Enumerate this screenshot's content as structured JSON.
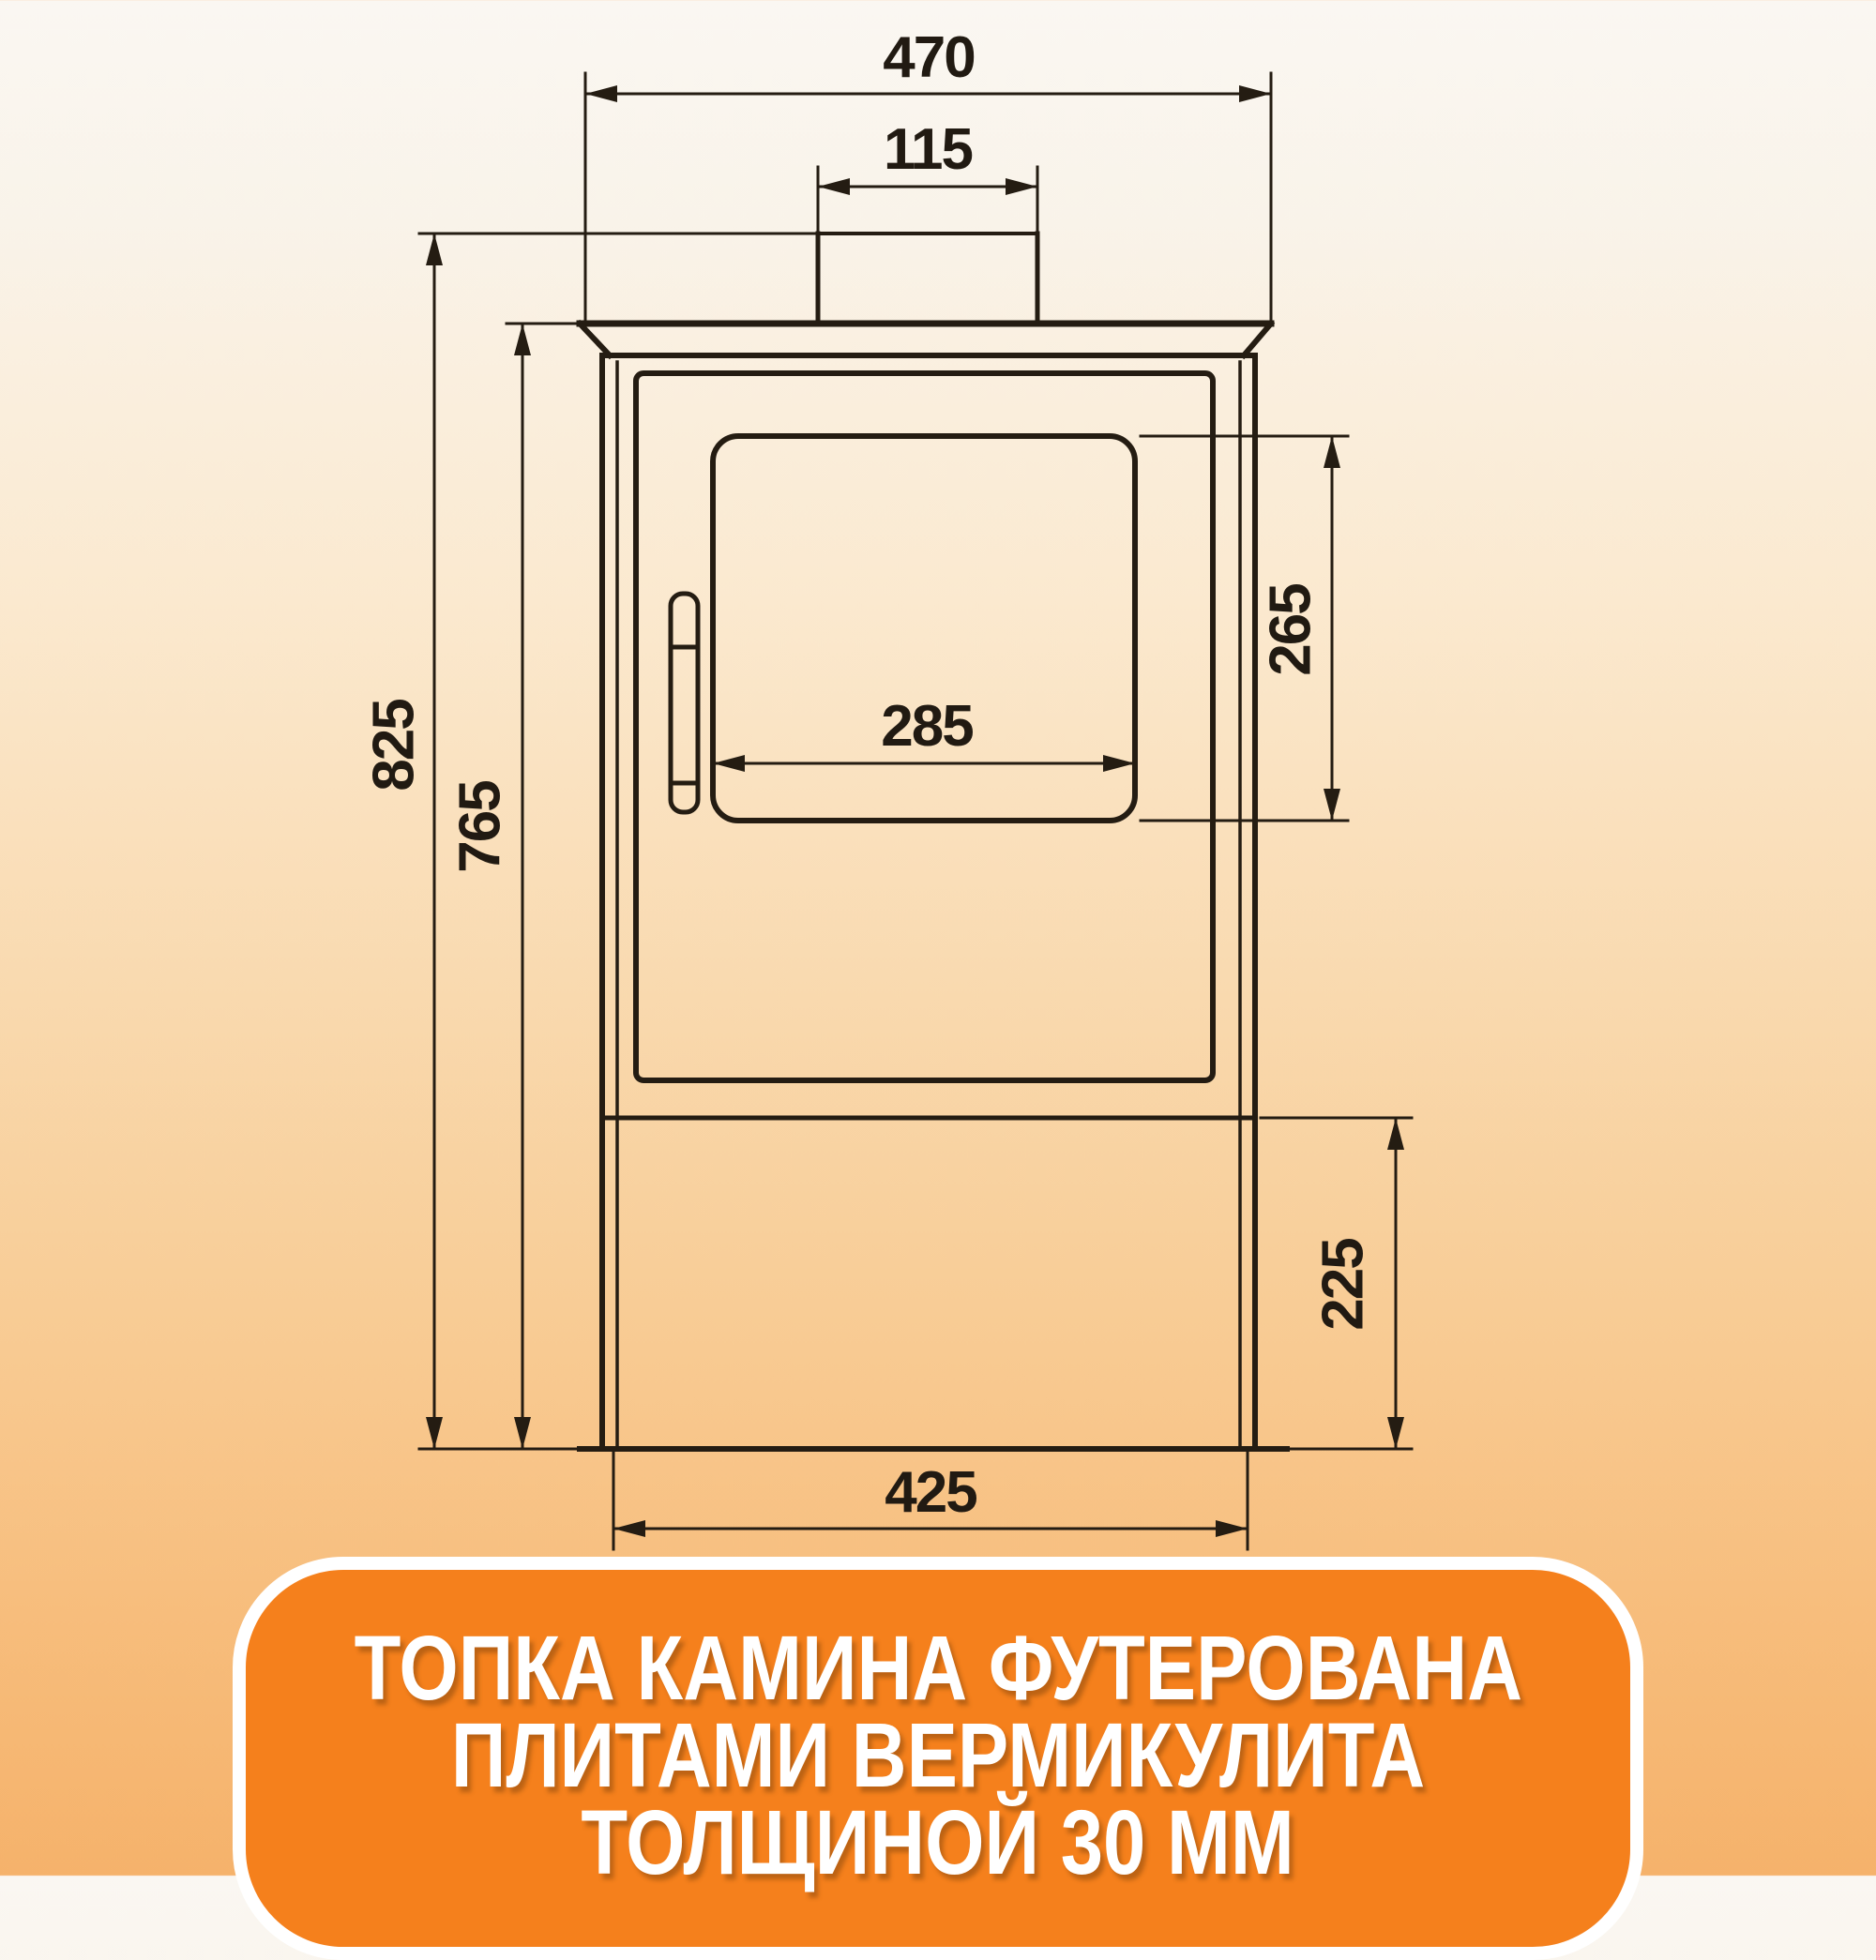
{
  "diagram": {
    "type": "technical-drawing",
    "subject": "wood-burning stove front view with dimensions",
    "units": "mm",
    "line_color": "#241c12",
    "dimensions": {
      "top_plate_width": {
        "value": "470",
        "orientation": "horizontal",
        "feature": "top plate width"
      },
      "flue_collar_width": {
        "value": "115",
        "orientation": "horizontal",
        "feature": "flue collar width"
      },
      "overall_height": {
        "value": "825",
        "orientation": "vertical",
        "feature": "floor to flue collar top"
      },
      "body_height": {
        "value": "765",
        "orientation": "vertical",
        "feature": "floor to top plate"
      },
      "glass_width": {
        "value": "285",
        "orientation": "horizontal",
        "feature": "door glass width"
      },
      "glass_height": {
        "value": "265",
        "orientation": "vertical",
        "feature": "door glass height"
      },
      "base_height": {
        "value": "225",
        "orientation": "vertical",
        "feature": "base compartment height"
      },
      "base_width": {
        "value": "425",
        "orientation": "horizontal",
        "feature": "base width"
      }
    }
  },
  "footer": {
    "line1": "ТОПКА КАМИНА ФУТЕРОВАНА",
    "line2": "ПЛИТАМИ ВЕРМИКУЛИТА",
    "line3": "ТОЛЩИНОЙ 30 ММ"
  },
  "colors": {
    "banner_orange": "#f5801c",
    "banner_border": "#ffffff",
    "background_top": "#faf7f2",
    "background_bottom": "#f5b26b",
    "drawing_lines": "#241c12"
  }
}
